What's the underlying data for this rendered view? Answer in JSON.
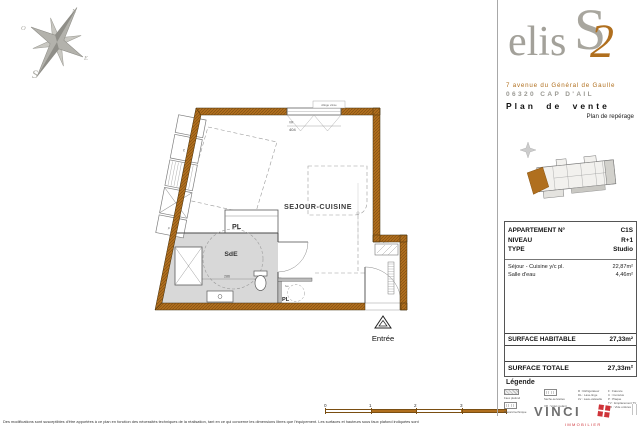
{
  "brand": {
    "elis": "elis",
    "s": "S",
    "two": "2",
    "address1": "7 avenue du Général de Gaulle",
    "address2": "06320 CAP D'AIL",
    "doc_title": "Plan de vente",
    "doc_subtitle": "Plan de repérage"
  },
  "compass": {
    "n": "N",
    "o": "O",
    "e": "E",
    "s": "S"
  },
  "plan": {
    "room": "SEJOUR-CUISINE",
    "sde": "SdE",
    "pl": "PL",
    "pl2": "PL",
    "lve": "lve",
    "entree": "Entrée",
    "allege": "Allège vitrée",
    "vr": "VR",
    "window_width": "404",
    "circle_dim": "286",
    "c": "c",
    "p": "p",
    "gaine": "gaine"
  },
  "info_table": {
    "rows_top": [
      {
        "label": "APPARTEMENT N°",
        "value": "C1S"
      },
      {
        "label": "NIVEAU",
        "value": "R+1"
      },
      {
        "label": "TYPE",
        "value": "Studio"
      }
    ],
    "rooms": [
      {
        "label": "Séjour - Cuisine y/c pl.",
        "value": "22,87m²"
      },
      {
        "label": "Salle d'eau",
        "value": "4,46m²"
      }
    ],
    "surface_habitable_label": "SURFACE HABITABLE",
    "surface_habitable_value": "27,33m²",
    "surface_totale_label": "SURFACE TOTALE",
    "surface_totale_value": "27,33m²"
  },
  "legend": {
    "title": "Légende",
    "item_faux_plafond": "Faux plafond",
    "item_placard_technique": "Placard technique",
    "item_seche_serviettes": "Sèche-serviettes",
    "item_volet": "VR : Volet roulant",
    "col3": [
      "R : Réfrigérateur",
      "DL : Lave-linge",
      "LV : Lave-vaisselle"
    ],
    "col4": [
      "F : Faïence",
      "C : Cumulus",
      "P : Plaque",
      "TV : Emplacement TV",
      "VO : Vide ordures"
    ]
  },
  "scale_bar": {
    "ticks": [
      "0",
      "1",
      "2",
      "3",
      "4"
    ]
  },
  "vinci": {
    "name": "VINCI",
    "sub": "IMMOBILIER"
  },
  "footer": {
    "disclaimer": "Des modifications sont susceptibles d'être apportées à ce plan en fonction des nécessités techniques de la réalisation, tant en ce qui concerne les dimensions libres que l'équipement. Les surfaces et hauteurs sous faux plafond indiquées sont"
  },
  "colors": {
    "accent": "#b06f1e",
    "logo_gray": "#a3a19a",
    "vinci_red": "#cf3339",
    "sde_gray": "#d8d8d8"
  }
}
